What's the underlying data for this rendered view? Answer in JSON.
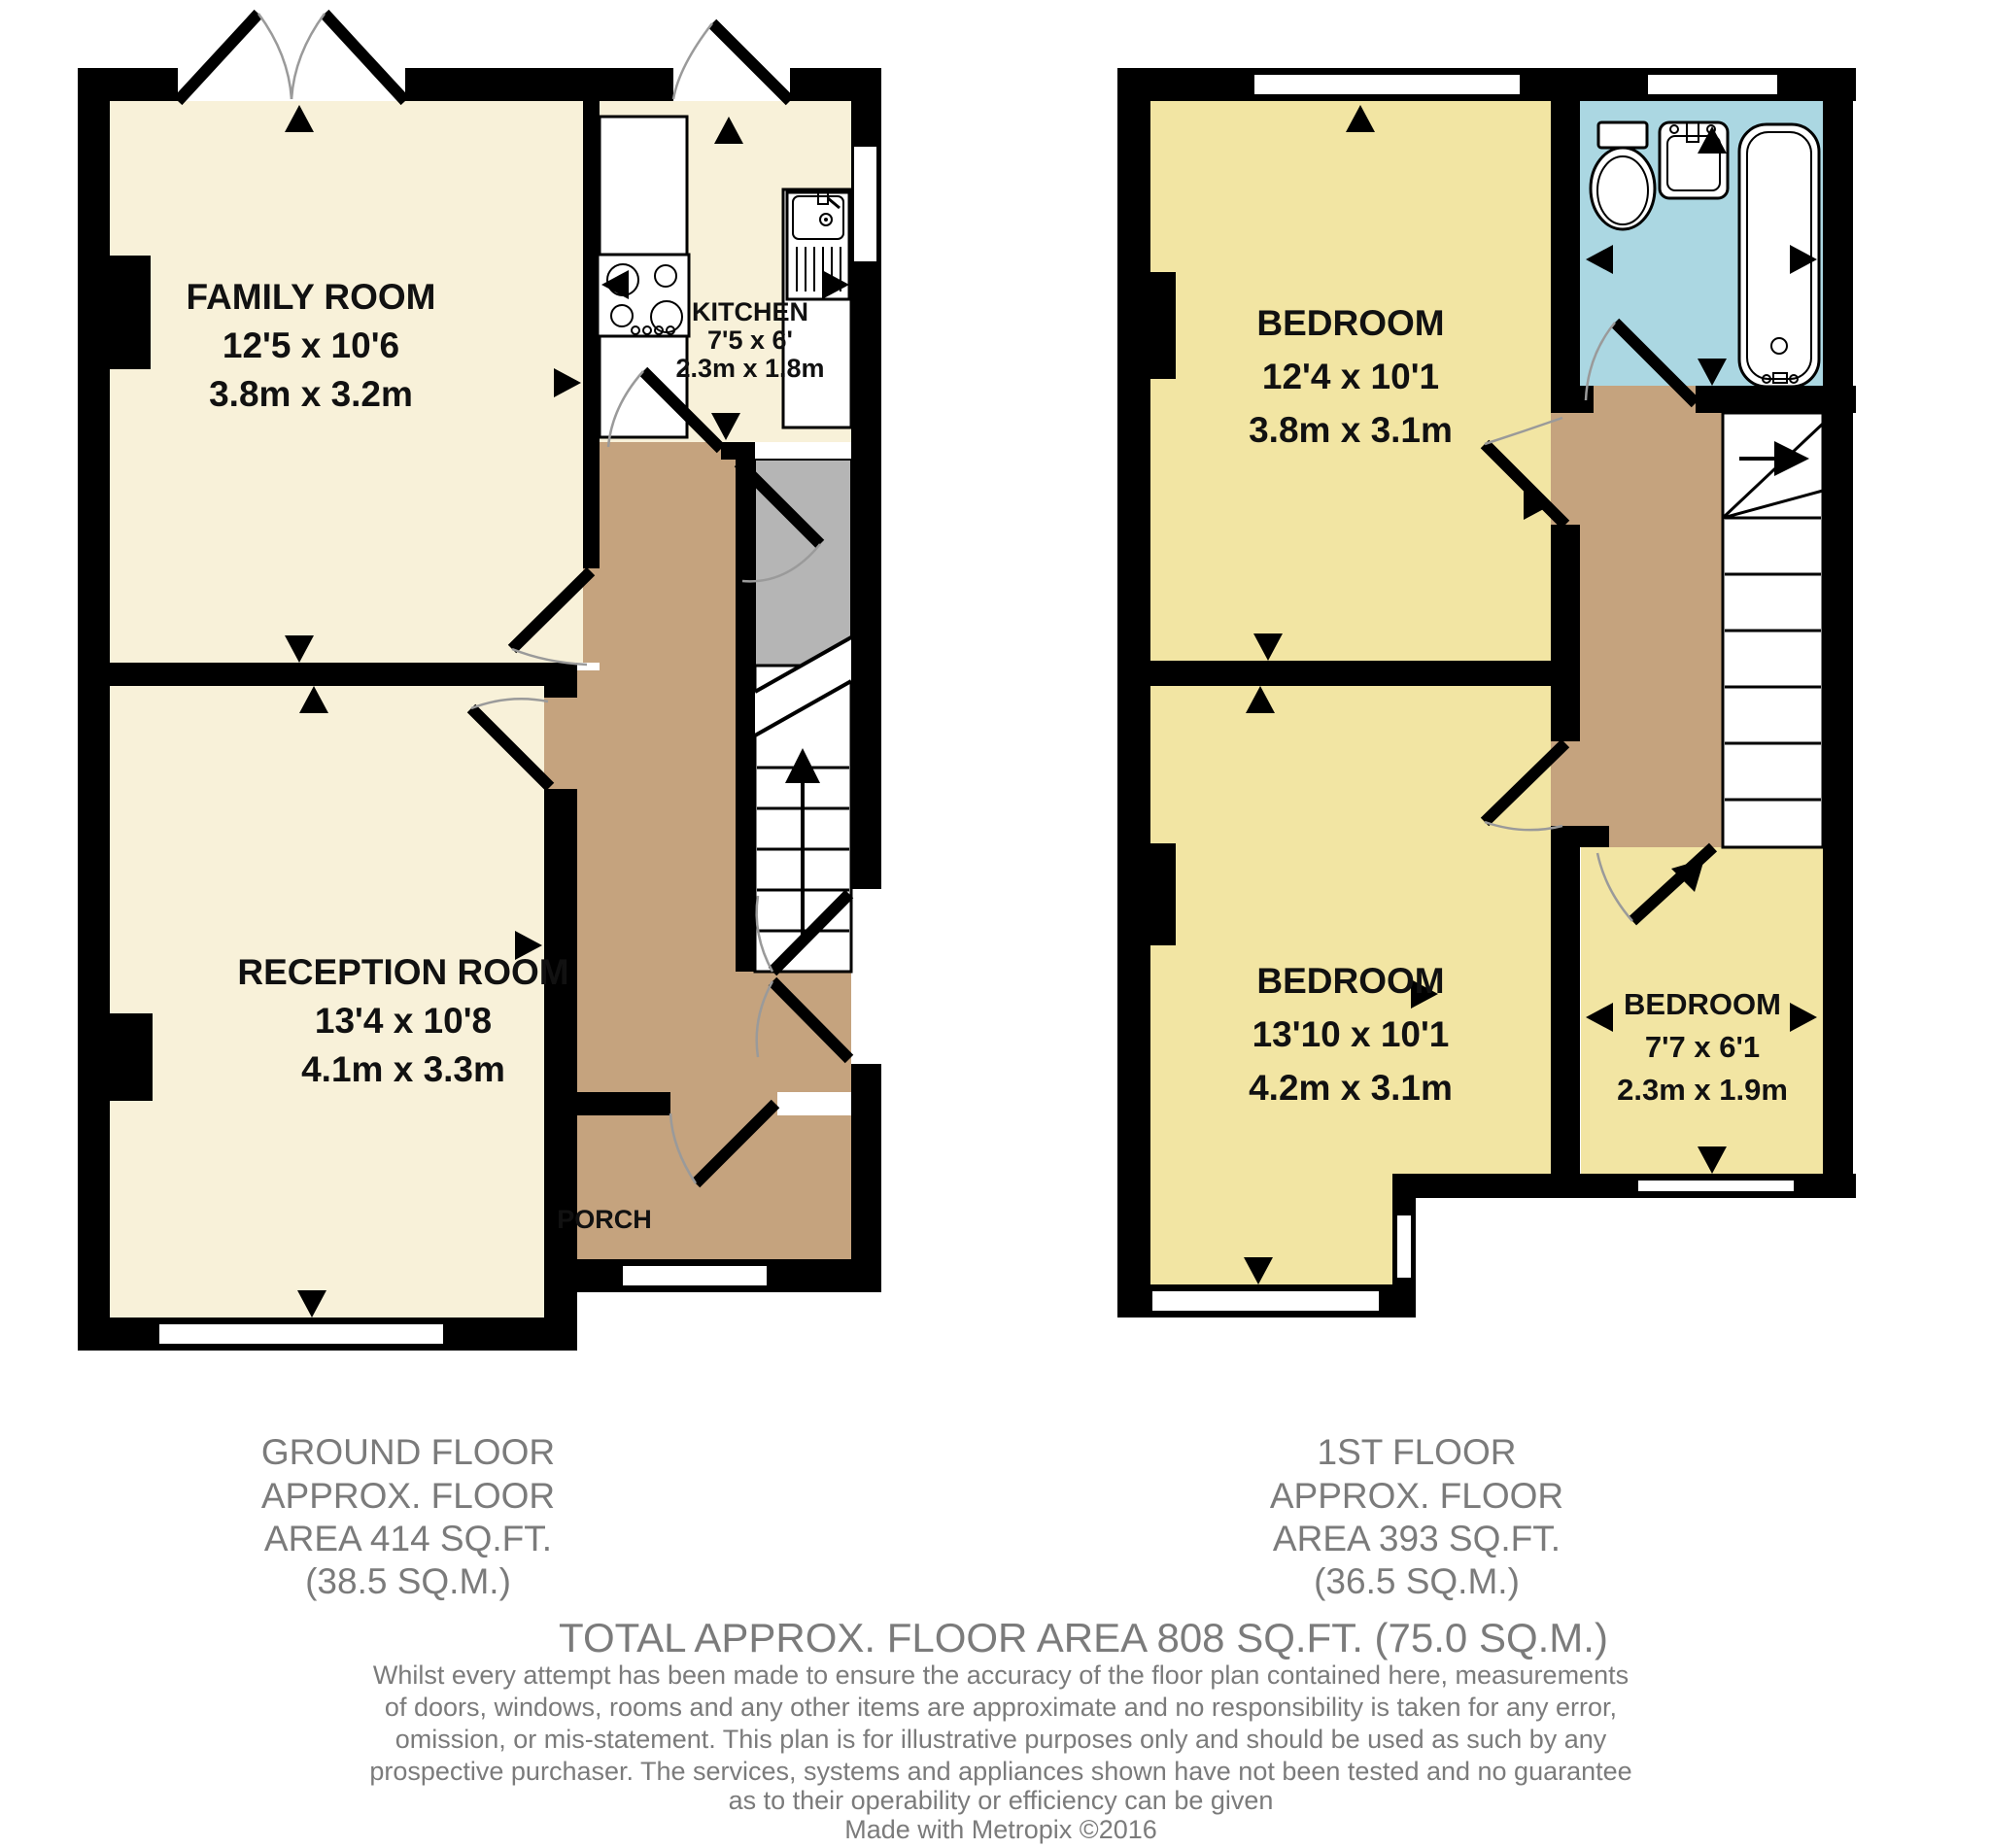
{
  "floors": {
    "ground": {
      "title_lines": [
        "GROUND FLOOR",
        "APPROX. FLOOR",
        "AREA 414 SQ.FT.",
        "(38.5 SQ.M.)"
      ],
      "rooms": {
        "family_room": {
          "name": "FAMILY ROOM",
          "imperial": "12'5 x 10'6",
          "metric": "3.8m x 3.2m"
        },
        "kitchen": {
          "name": "KITCHEN",
          "imperial": "7'5 x 6'",
          "metric": "2.3m x 1.8m"
        },
        "reception_room": {
          "name": "RECEPTION ROOM",
          "imperial": "13'4 x 10'8",
          "metric": "4.1m x 3.3m"
        },
        "porch": {
          "name": "PORCH"
        }
      }
    },
    "first": {
      "title_lines": [
        "1ST FLOOR",
        "APPROX. FLOOR",
        "AREA 393 SQ.FT.",
        "(36.5 SQ.M.)"
      ],
      "rooms": {
        "bedroom_1": {
          "name": "BEDROOM",
          "imperial": "12'4 x 10'1",
          "metric": "3.8m x 3.1m"
        },
        "bedroom_2": {
          "name": "BEDROOM",
          "imperial": "13'10 x 10'1",
          "metric": "4.2m x 3.1m"
        },
        "bedroom_3": {
          "name": "BEDROOM",
          "imperial": "7'7 x 6'1",
          "metric": "2.3m x 1.9m"
        }
      }
    }
  },
  "footer": {
    "total_area": "TOTAL APPROX. FLOOR AREA 808 SQ.FT. (75.0 SQ.M.)",
    "disclaimer_lines": [
      "Whilst every attempt has been made to ensure the accuracy of the floor plan contained here, measurements",
      "of doors, windows, rooms and any other items are approximate and no responsibility is taken for any error,",
      "omission, or mis-statement. This plan is for illustrative purposes only and should be used as such by any",
      "prospective purchaser. The services, systems and appliances shown have not been tested and no guarantee",
      "as to their operability or efficiency can be given",
      "Made with Metropix ©2016"
    ]
  },
  "colors": {
    "floor_cream": "#f8f1d9",
    "floor_yellow": "#f2e5a3",
    "hallway_brown": "#c5a37e",
    "storage_gray": "#b5b5b5",
    "bathroom_blue": "#abd7e2",
    "wall_black": "#000000",
    "label_text": "#111111",
    "footer_text": "#7b7b7b"
  },
  "icons": {
    "hob": "hob-icon",
    "kitchen_sink": "sink-drainer-icon",
    "toilet": "toilet-icon",
    "basin": "basin-icon",
    "bath": "bath-icon",
    "stairs_ground": "stairs-up-icon",
    "stairs_first": "stairs-icon",
    "dimension_arrow": "dimension-arrow-icon",
    "door_swing": "door-swing-icon",
    "window": "window-icon"
  }
}
